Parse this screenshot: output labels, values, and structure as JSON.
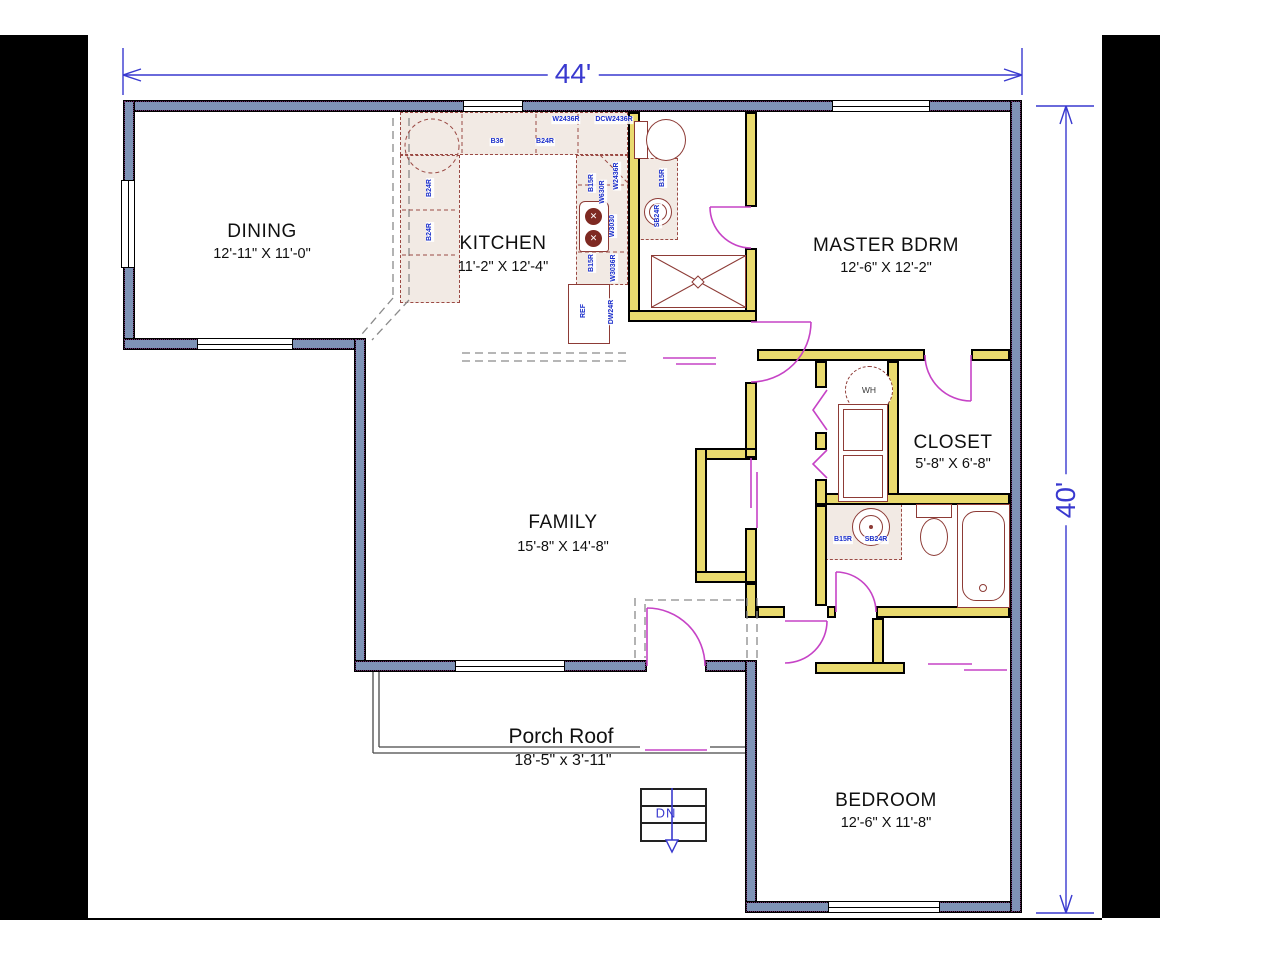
{
  "plan_title": "Floor Plan",
  "dimensions": {
    "width": "44'",
    "height": "40'"
  },
  "rooms": {
    "dining": {
      "name": "DINING",
      "size": "12'-11\" X 11'-0\""
    },
    "kitchen": {
      "name": "KITCHEN",
      "size": "11'-2\" X 12'-4\""
    },
    "master": {
      "name": "MASTER BDRM",
      "size": "12'-6\" X 12'-2\""
    },
    "closet": {
      "name": "CLOSET",
      "size": "5'-8\" X 6'-8\""
    },
    "family": {
      "name": "FAMILY",
      "size": "15'-8\" X 14'-8\""
    },
    "bedroom": {
      "name": "BEDROOM",
      "size": "12'-6\" X 11'-8\""
    },
    "porch": {
      "name": "Porch Roof",
      "size": "18'-5\" x 3'-11\""
    }
  },
  "kitchen_cabinets": {
    "c1": "W2436R",
    "c2": "DCW2436R",
    "c3": "B36",
    "c4": "B24R",
    "c5": "B24R",
    "c6": "B24R",
    "c7": "B15R",
    "c8": "W630R",
    "c9": "W2436R",
    "c10": "W3030",
    "c11": "B15R",
    "c12": "W3036R",
    "c13": "DW24R",
    "c14": "REF"
  },
  "hall_bath": {
    "cab1": "B15R",
    "cab2": "SB24R"
  },
  "master_bath": {
    "cab1": "B15R",
    "cab2": "SB24R"
  },
  "laundry": {
    "water_heater": "WH"
  },
  "stairs": {
    "label": "DN"
  },
  "colors": {
    "exterior_wall": "#7e93b6",
    "interior_wall": "#e9da6e",
    "door": "#c643c6",
    "dimension_blue": "#3939cf",
    "cabinet_text": "#1a2ecb",
    "fixture_stroke": "#8d3b36",
    "cabinet_fill": "#f2eae4",
    "matte": "#000000",
    "background": "#ffffff"
  }
}
